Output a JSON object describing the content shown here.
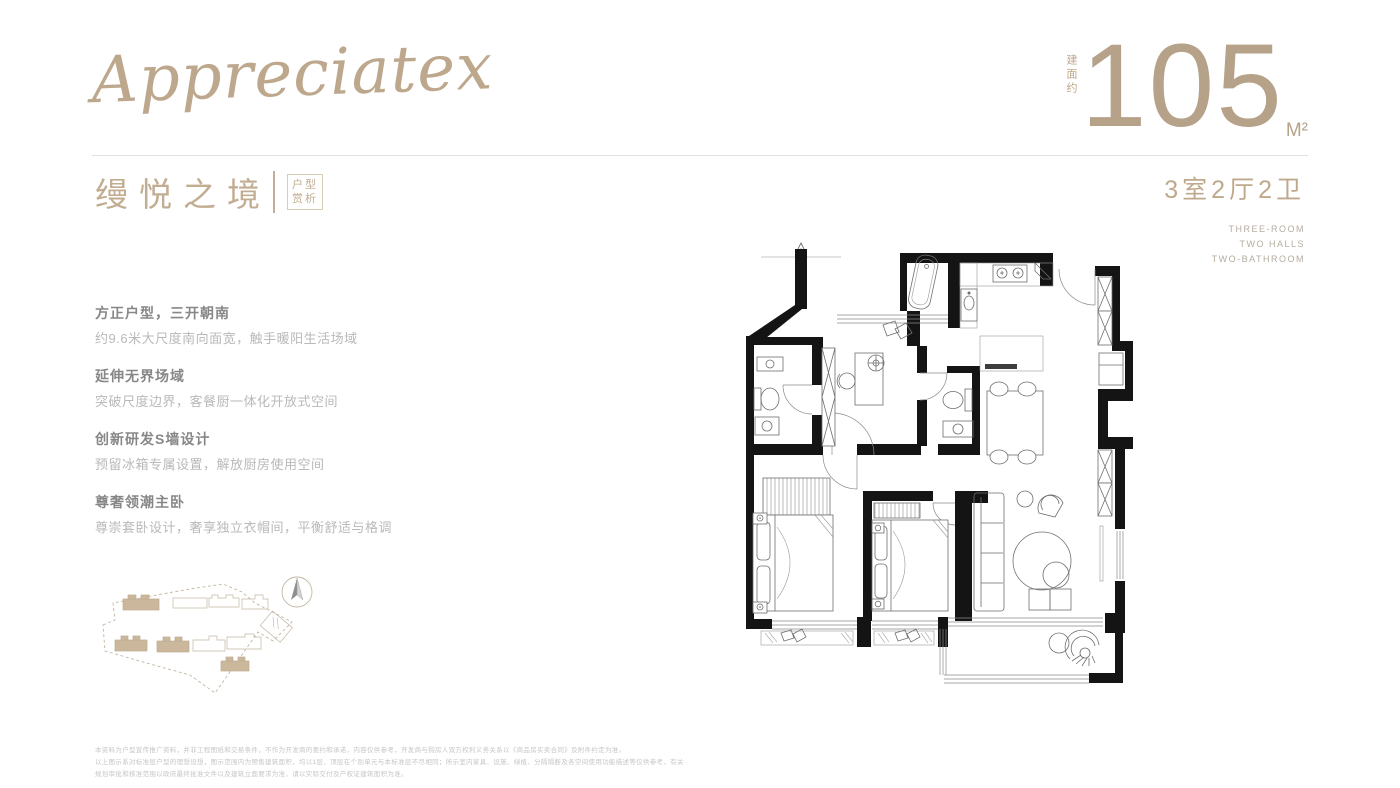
{
  "brand": {
    "script_logo": "Appreciatex"
  },
  "area_badge": {
    "prefix_vertical": "建面约",
    "number": "105",
    "unit": "M²"
  },
  "title_block": {
    "title": "缦悦之境",
    "tag_line1": "户型",
    "tag_line2": "赏析"
  },
  "spec": {
    "rooms": "3室2厅2卫",
    "en_line1": "THREE-ROOM",
    "en_line2": "TWO HALLS",
    "en_line3": "TWO-BATHROOM"
  },
  "features": [
    {
      "title": "方正户型，三开朝南",
      "desc": "约9.6米大尺度南向面宽，触手暖阳生活场域"
    },
    {
      "title": "延伸无界场域",
      "desc": "突破尺度边界，客餐厨一体化开放式空间"
    },
    {
      "title": "创新研发S墙设计",
      "desc": "预留冰箱专属设置，解放厨房使用空间"
    },
    {
      "title": "尊奢领潮主卧",
      "desc": "尊崇套卧设计，奢享独立衣帽间，平衡舒适与格调"
    }
  ],
  "disclaimer": {
    "line1": "本资料为户型宣传推广资料，并非工程图纸和交易条件，不作为开发商的要约和承诺，内容仅供参考，开发商与购房人双方权利义务关系以《商品房买卖合同》及附件约定为准。",
    "line2": "以上图示系对标准层户型的理想设想，图示范围内为预售建筑面积，均以1层、顶层在个别单元与本标准层不尽相同；所示室内家具、设施、绿植、分隔隔断及各空间使用功能描述等仅供参考，有关",
    "line3": "规划审批和核准范围以政府最终批准文件以及建筑立面要求为准，请以实际交付及产权证建筑面积为准。"
  },
  "colors": {
    "accent_tan": "#b6a288",
    "accent_tan_light": "#c2ad92",
    "tag_border": "#d9cbb5",
    "feature_title_gray": "#878787",
    "feature_desc_gray": "#b9b9b9",
    "wall_black": "#141414",
    "site_building_fill": "#cbb79b"
  },
  "icons": {
    "compass": "compass-icon",
    "north_arrow": "north-arrow-icon"
  }
}
